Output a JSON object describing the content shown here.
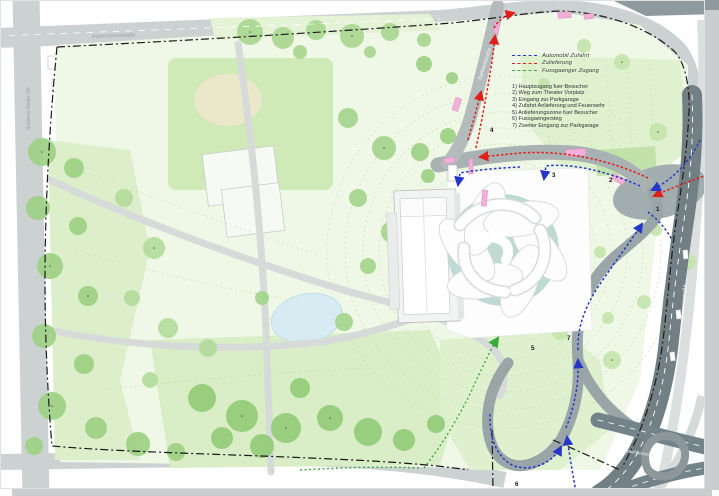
{
  "legend": {
    "routes": [
      {
        "label": "Automobil Zufahrt",
        "color": "#2636c8"
      },
      {
        "label": "Zulieferung",
        "color": "#e01e1a"
      },
      {
        "label": "Fussgaenger Zugang",
        "color": "#3aa83a"
      }
    ],
    "items": [
      {
        "label": "1) Hauptzugang fuer Besucher"
      },
      {
        "label": "2) Weg zum Theater Vorplatz"
      },
      {
        "label": "3) Eingang zur Parkgarage"
      },
      {
        "label": "4) Zufahrt Anlieferung und Feuerwehr"
      },
      {
        "label": "5) Anlieferungszone fuer Besucher"
      },
      {
        "label": "6) Fussgaengersteg"
      },
      {
        "label": "7) Zweiter Eingang zur Parkgarage"
      }
    ]
  },
  "markers": [
    "1",
    "2",
    "3",
    "4",
    "5",
    "6",
    "7"
  ],
  "streets": [
    "Ackermannstraße",
    "Schwere-Reiter-Str.",
    "Barbarastraße",
    "Winzererstraße",
    "Anschlussstelle"
  ],
  "colors": {
    "park_wash": "#eff7e6",
    "meadow": "#d9eec6",
    "field": "#cfeab6",
    "tree": "#9ed184",
    "water": "#d6ebf2",
    "road_light": "#ccd1d1",
    "road_medium": "#a8b2b3",
    "road_dark": "#728086",
    "boundary": "#1a1a1a",
    "route_car": "#2636c8",
    "route_delivery": "#e01e1a",
    "route_ped": "#3aa83a",
    "tram_pink": "#f2b0d8",
    "building": "#ffffff",
    "glass_teal": "#bfd9d3"
  }
}
